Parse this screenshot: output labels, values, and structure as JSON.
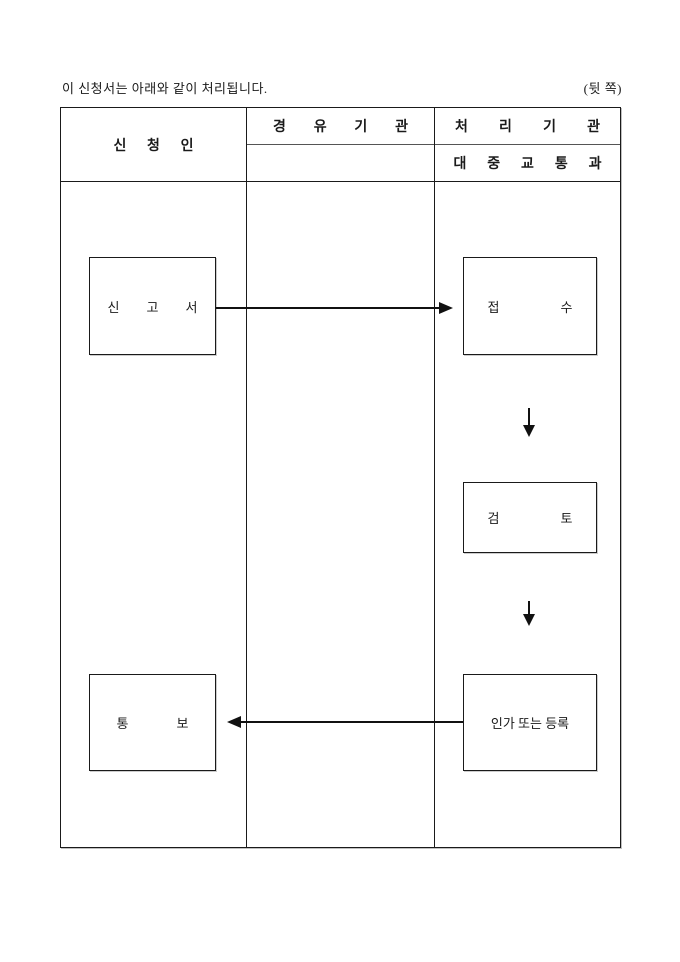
{
  "page": {
    "note": "이 신청서는 아래와 같이 처리됩니다.",
    "corner_label": "(뒷 쪽)"
  },
  "table": {
    "columns": [
      {
        "header": "신 청 인"
      },
      {
        "header": "경 유 기 관",
        "subheader": ""
      },
      {
        "header": "처 리 기 관",
        "subheader": "대 중 교 통 과"
      }
    ]
  },
  "flow": {
    "nodes": {
      "report": "신 고 서",
      "receipt": "접 수",
      "review": "검 토",
      "approval": "인가 또는 등록",
      "notice": "통 보"
    },
    "edges": [
      {
        "from": "report",
        "to": "receipt",
        "direction": "right"
      },
      {
        "from": "receipt",
        "to": "review",
        "direction": "down"
      },
      {
        "from": "review",
        "to": "approval",
        "direction": "down"
      },
      {
        "from": "approval",
        "to": "notice",
        "direction": "left"
      }
    ],
    "colors": {
      "line": "#111111",
      "text": "#1a1a1a",
      "background": "#ffffff"
    }
  }
}
